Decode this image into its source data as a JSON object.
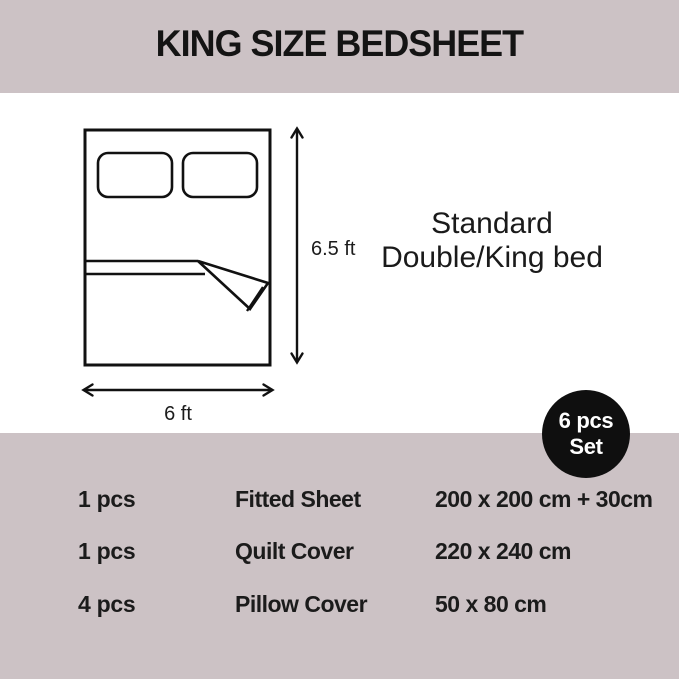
{
  "colors": {
    "band": "#ccc2c5",
    "ink": "#1c1c1c",
    "badge-bg": "#0f0f0f",
    "badge-ink": "#ffffff",
    "paper": "#ffffff"
  },
  "header": {
    "title": "KING SIZE BEDSHEET"
  },
  "diagram": {
    "height_label": "6.5 ft",
    "width_label": "6 ft",
    "caption_line1": "Standard",
    "caption_line2": "Double/King bed"
  },
  "badge": {
    "line1": "6 pcs",
    "line2": "Set"
  },
  "set_table": {
    "rows": [
      {
        "qty": "1 pcs",
        "item": "Fitted Sheet",
        "size": "200 x 200 cm + 30cm"
      },
      {
        "qty": "1 pcs",
        "item": "Quilt Cover",
        "size": "220 x 240 cm"
      },
      {
        "qty": "4 pcs",
        "item": "Pillow Cover",
        "size": "50 x 80 cm"
      }
    ]
  }
}
